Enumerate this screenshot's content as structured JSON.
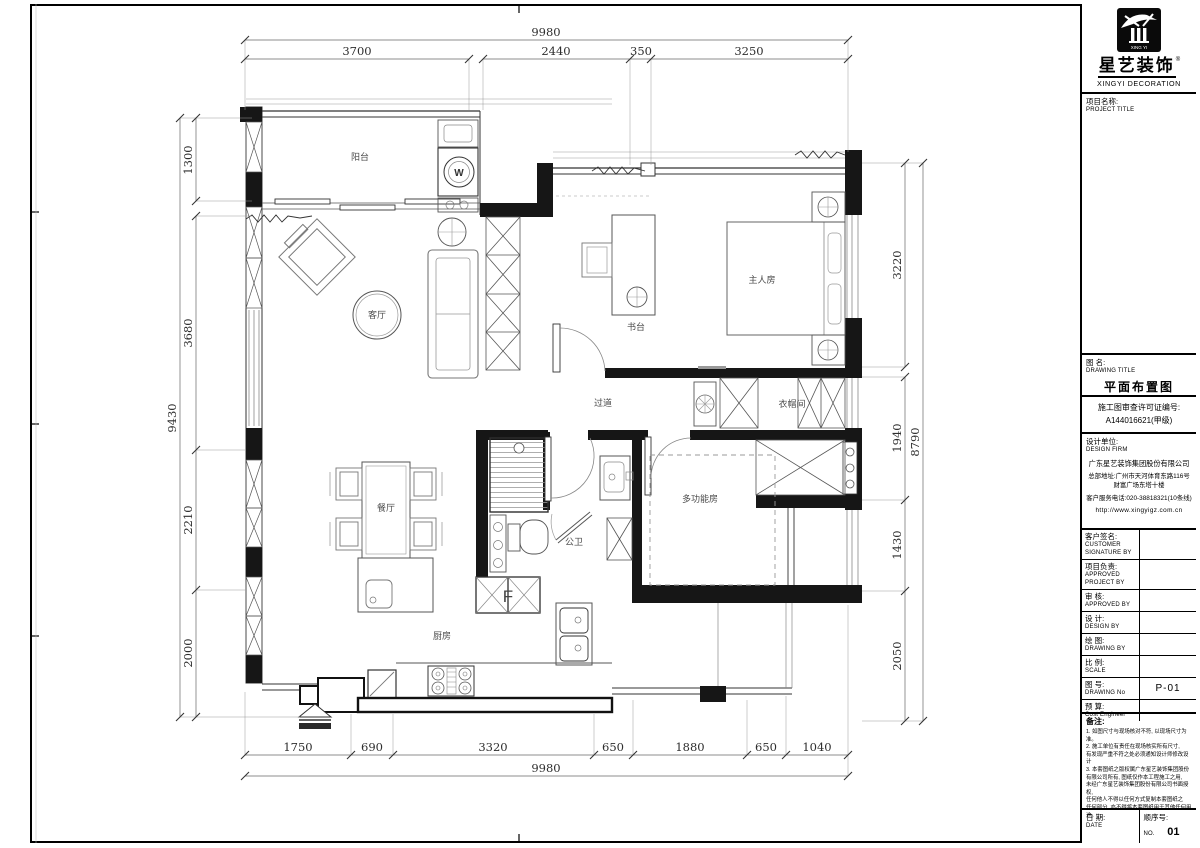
{
  "sheet": {
    "brand": {
      "cn": "星艺装饰",
      "reg": "®",
      "en": "XINGYI DECORATION",
      "logo_sub": "XING YI"
    },
    "title_block": {
      "project_label": "项目名称:",
      "project_label_en": "PROJECT TITLE",
      "drawing_label": "图 名:",
      "drawing_label_en": "DRAWING  TITLE",
      "drawing_title": "平面布置图",
      "license_line1": "施工图审查许可证编号:",
      "license_line2": "A144016621(甲级)",
      "firm_label": "设计单位:",
      "firm_label_en": "DESIGN FIRM",
      "firm_name": "广东星艺装饰集团股份有限公司",
      "firm_addr1": "总部地址:广州市天河体育东路116号",
      "firm_addr2": "财富广场东塔十楼",
      "firm_phone": "客户服务电话:020-38818321(10条线)",
      "firm_web": "http://www.xingyigz.com.cn",
      "rows": [
        {
          "cn": "客户签名:",
          "en": "CUSTOMER SIGNATURE BY",
          "value": ""
        },
        {
          "cn": "项目负责:",
          "en": "APPROVED PROJECT BY",
          "value": ""
        },
        {
          "cn": "审 核:",
          "en": "APPROVED BY",
          "value": ""
        },
        {
          "cn": "设 计:",
          "en": "DESIGN BY",
          "value": ""
        },
        {
          "cn": "绘 图:",
          "en": "DRAWING BY",
          "value": ""
        },
        {
          "cn": "比 例:",
          "en": "SCALE",
          "value": ""
        },
        {
          "cn": "图 号:",
          "en": "DRAWING No",
          "value": "P-01"
        },
        {
          "cn": "预 算:",
          "en": "Cost Engineer",
          "value": ""
        }
      ],
      "notes_label": "备注:",
      "notes": [
        "1. 如图尺寸与现场核对不符, 以现场尺寸为准。",
        "2. 施工单位有责任在现场核实所有尺寸,",
        "   有发现严重不符之处必须通知设计师修改设计",
        "3. 本套图纸之版权属广东星艺装饰集团股份",
        "   有限公司所有, 图纸仅作本工程施工之用,",
        "   未经广东星艺装饰集团股份有限公司书面授权,",
        "   任何他人不得以任何方式复制本套图纸之",
        "   任何部分, 亦不得将本套图纸用于其他任何用途。"
      ],
      "date_cn": "日 期:",
      "date_en": "DATE",
      "seq_cn": "顺序号:",
      "seq_no_label": "NO.",
      "seq_value": "01"
    }
  },
  "plan": {
    "rooms": {
      "balcony": "阳台",
      "living": "客厅",
      "master": "主人房",
      "desk": "书台",
      "corridor": "过道",
      "cloak": "衣帽间",
      "dining": "餐厅",
      "multi": "多功能房",
      "bath": "公卫",
      "kitchen": "厨房",
      "washer": "W",
      "flue": "F"
    },
    "dims": {
      "top_overall": "9980",
      "top": [
        "3700",
        "2440",
        "350",
        "3250"
      ],
      "bottom": [
        "1750",
        "690",
        "3320",
        "650",
        "1880",
        "650",
        "1040"
      ],
      "bottom_overall": "9980",
      "left_overall": "9430",
      "left": [
        "1300",
        "3680",
        "2210",
        "2000"
      ],
      "right_overall": "8790",
      "right": [
        "3220",
        "1940",
        "1430",
        "2050"
      ]
    },
    "colors": {
      "wall": "#161616",
      "furniture": "#7d7d7d",
      "dim_text": "#2e2e2e"
    }
  }
}
